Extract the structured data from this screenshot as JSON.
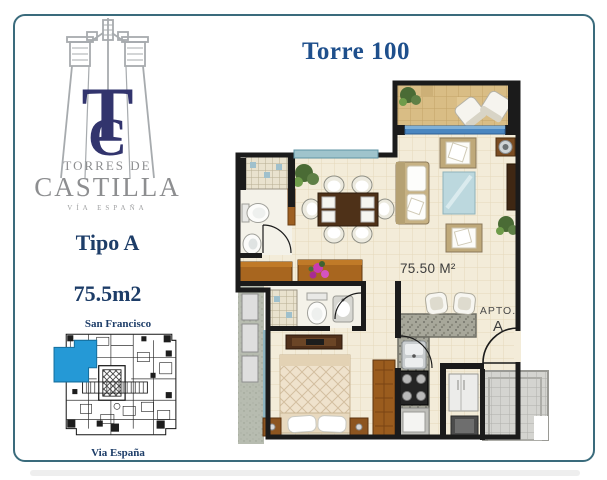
{
  "brand": {
    "monogram_t": "T",
    "monogram_c": "C",
    "line1": "TORRES DE",
    "line2": "CASTILLA",
    "line3": "VÍA ESPAÑA"
  },
  "unit": {
    "type_label": "Tipo A",
    "area_label": "75.5m2"
  },
  "site_map": {
    "top_label": "San Francisco",
    "bottom_label": "Via España"
  },
  "plan": {
    "title": "Torre 100",
    "area_label": "75.50 M²",
    "apto_label": "APTO.",
    "apto_letter": "A"
  },
  "colors": {
    "navy": "#1d3d68",
    "torre_blue": "#1e4f8c",
    "monogram_navy": "#32346d",
    "logo_gray": "#8d8e90",
    "border_teal": "#3a6b7c",
    "highlight_blue": "#2599d6",
    "wall_black": "#1b1b1b",
    "floor_cream": "#f3ecd9",
    "balcony_tan": "#d9bd85",
    "wood_brown": "#a8661f",
    "granite_gray": "#a7a79a",
    "glass_blue": "#4a86c0"
  }
}
